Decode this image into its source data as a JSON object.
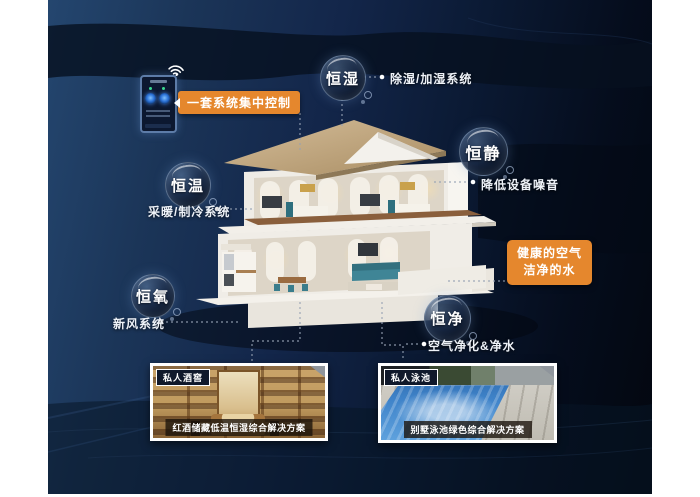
{
  "infographic": {
    "control_app": {
      "label": "一套系统集中控制",
      "wifi_icon": "wifi",
      "device": "smart-home-controller"
    },
    "bubbles": [
      {
        "name": "恒湿",
        "desc": "除湿/加湿系统"
      },
      {
        "name": "恒静",
        "desc": "降低设备噪音"
      },
      {
        "name": "恒温",
        "desc": "采暖/制冷系统"
      },
      {
        "name": "恒氧",
        "desc": "新风系统"
      },
      {
        "name": "恒净",
        "desc": "空气净化&净水"
      }
    ],
    "highlight_box": {
      "line1": "健康的空气",
      "line2": "洁净的水"
    },
    "cards": [
      {
        "badge": "私人酒窖",
        "caption": "红酒储藏低温恒湿综合解决方案"
      },
      {
        "badge": "私人泳池",
        "caption": "别墅泳池绿色综合解决方案"
      }
    ],
    "colors": {
      "accent_orange": "#e5872d",
      "background_navy": "#13264a",
      "deep_navy": "#03070f",
      "connector_gray": "#96a2b4"
    }
  }
}
